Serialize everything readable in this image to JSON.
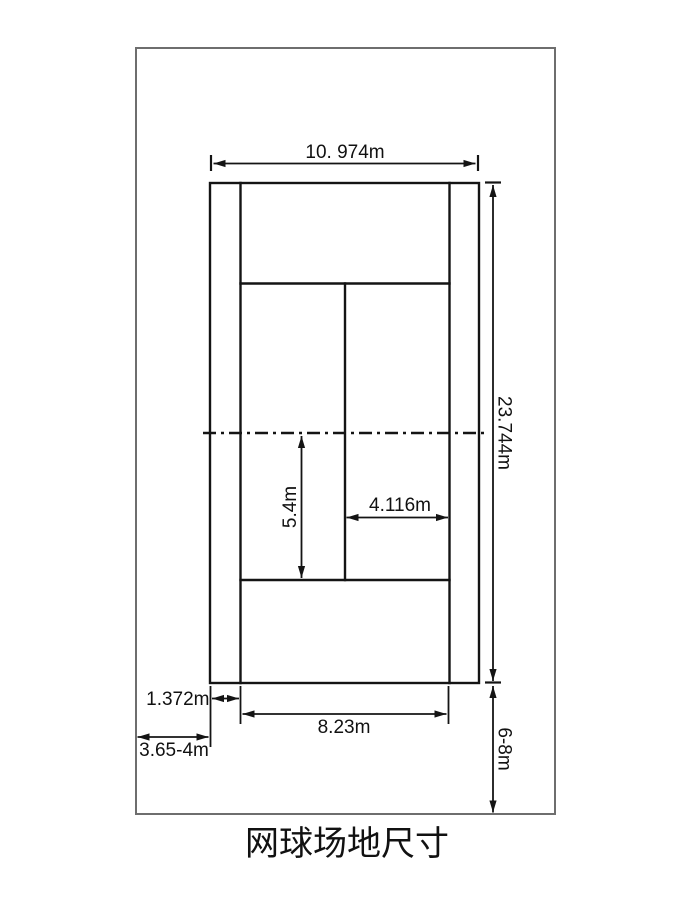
{
  "title": "网球场地尺寸",
  "dimension_labels": {
    "overall_width": "10. 974m",
    "overall_length": "23.744m",
    "net_to_service_line": "5.4m",
    "service_box_width": "4.116m",
    "alley_width": "1.372m",
    "singles_width": "8.23m",
    "side_clearance": "3.65-4m",
    "end_clearance": "6-8m"
  },
  "colors": {
    "court_line": "#141414",
    "frame_line": "#6e6e6e",
    "text": "#111111",
    "background": "#ffffff"
  }
}
